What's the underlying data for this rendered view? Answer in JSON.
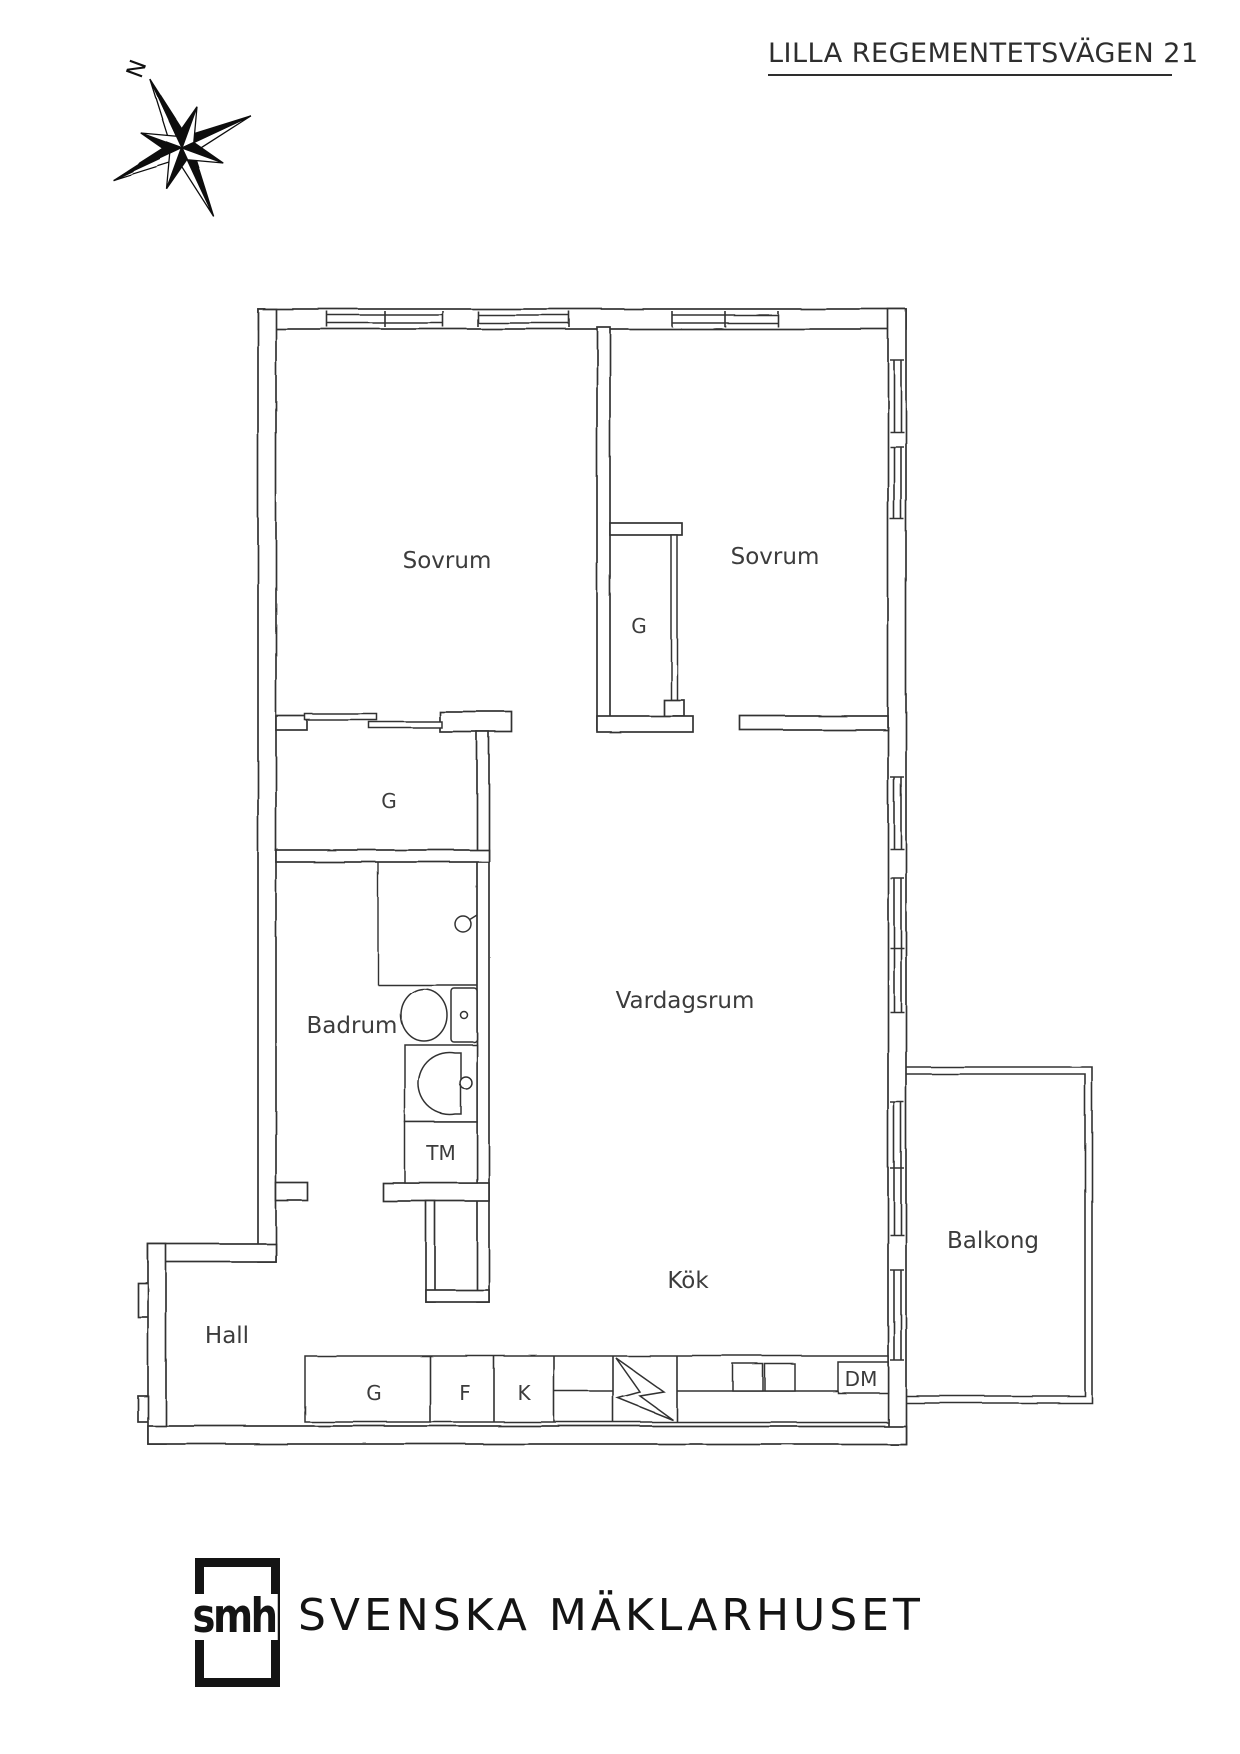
{
  "header": {
    "title": "LILLA REGEMENTETSVÄGEN 21"
  },
  "compass": {
    "north": "N"
  },
  "rooms": {
    "sovrum_left": "Sovrum",
    "sovrum_right": "Sovrum",
    "vardagsrum": "Vardagsrum",
    "badrum": "Badrum",
    "kok": "Kök",
    "hall": "Hall",
    "balkong": "Balkong"
  },
  "fixtures": {
    "wardrobe_mid": "G",
    "wardrobe_left": "G",
    "washing_machine": "TM",
    "cabinet": "G",
    "fridge": "F",
    "freezer": "K",
    "dishwasher": "DM"
  },
  "footer": {
    "monogram": "smh",
    "brand": "SVENSKA MÄKLARHUSET"
  },
  "colors": {
    "ink": "#333333",
    "paper": "#ffffff"
  }
}
